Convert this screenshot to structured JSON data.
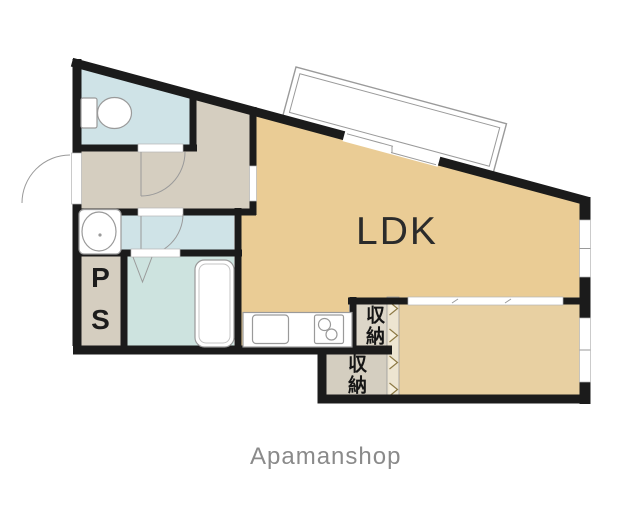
{
  "plan": {
    "type": "apartment-floor-plan",
    "rooms": {
      "ldk_label": "LDK",
      "ps_label": "PS",
      "storage_top_label": "収納",
      "storage_bottom_label": "収納"
    },
    "brand": "Apamanshop"
  },
  "colors": {
    "wall": "#1b1b1b",
    "ldk": "#eacc95",
    "bedroom": "#e8d0a2",
    "hall": "#d5cec0",
    "wet": "#cfe3e7",
    "bath": "#cde3df",
    "closet1": "#dcd6c8",
    "closet2": "#d4cec0",
    "strip": "#ede5d1",
    "chevron": "#8d7a46",
    "fixture": "#9a9a9a",
    "text": "#2b2b2b",
    "brand": "#8a8a8a"
  }
}
